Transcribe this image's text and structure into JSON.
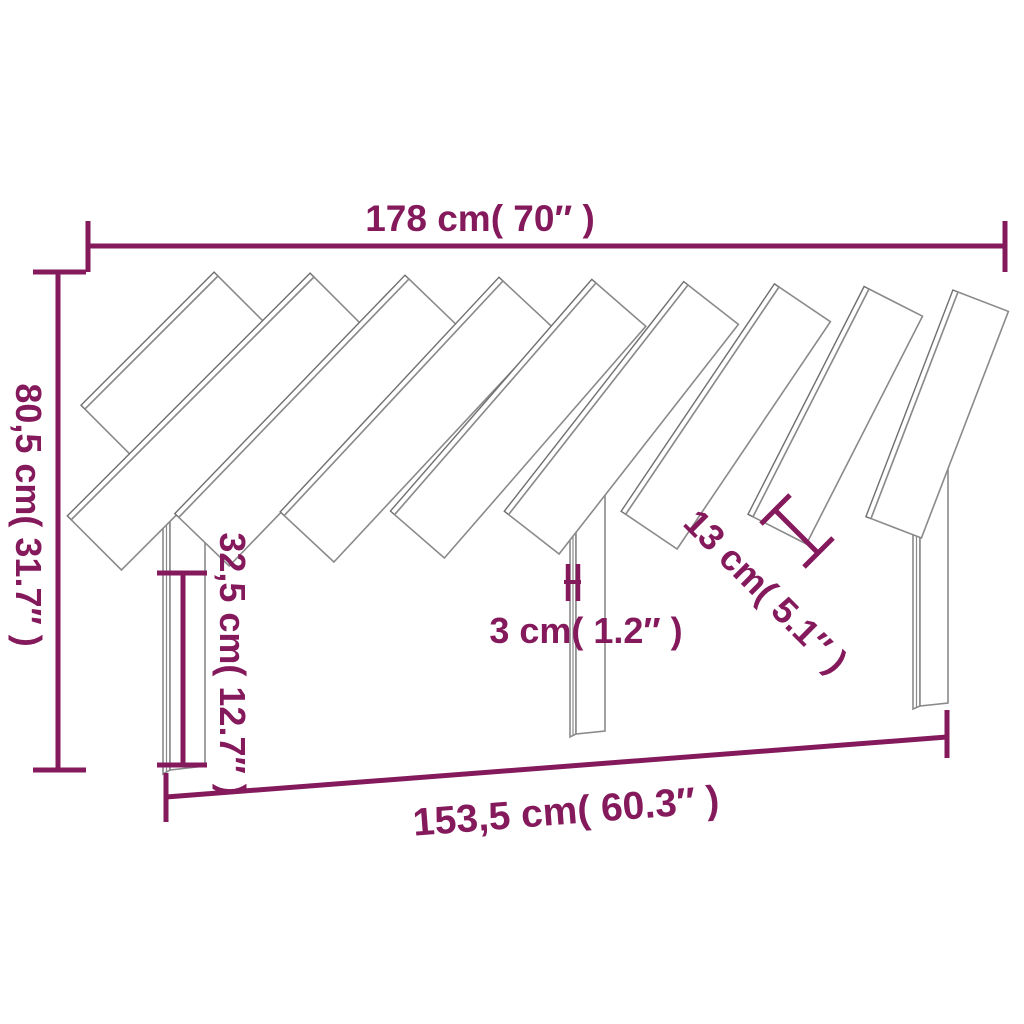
{
  "diagram": {
    "kind": "furniture-dimension-drawing",
    "subject": "headboard with diagonal wooden slats and three legs",
    "slat_count": 9,
    "leg_count": 3,
    "colors": {
      "dimension": "#841A5C",
      "outline": "#8a8a8a",
      "outline_dark": "#6f6f6f",
      "background": "#ffffff"
    },
    "dimensions": {
      "top_width": {
        "label": "178 cm( 70″  )",
        "cm": "178",
        "inch": "70"
      },
      "left_height": {
        "label": "80,5 cm( 31.7″ )",
        "cm": "80,5",
        "inch": "31.7"
      },
      "leg_height": {
        "label": "32,5 cm( 12.7″ )",
        "cm": "32,5",
        "inch": "12.7"
      },
      "leg_thickness": {
        "label": "3 cm( 1.2″ )",
        "cm": "3",
        "inch": "1.2"
      },
      "slat_gap": {
        "label": "13 cm( 5.1″ )",
        "cm": "13",
        "inch": "5.1"
      },
      "bottom_width": {
        "label": "153,5 cm( 60.3″ )",
        "cm": "153,5",
        "inch": "60.3"
      }
    }
  }
}
